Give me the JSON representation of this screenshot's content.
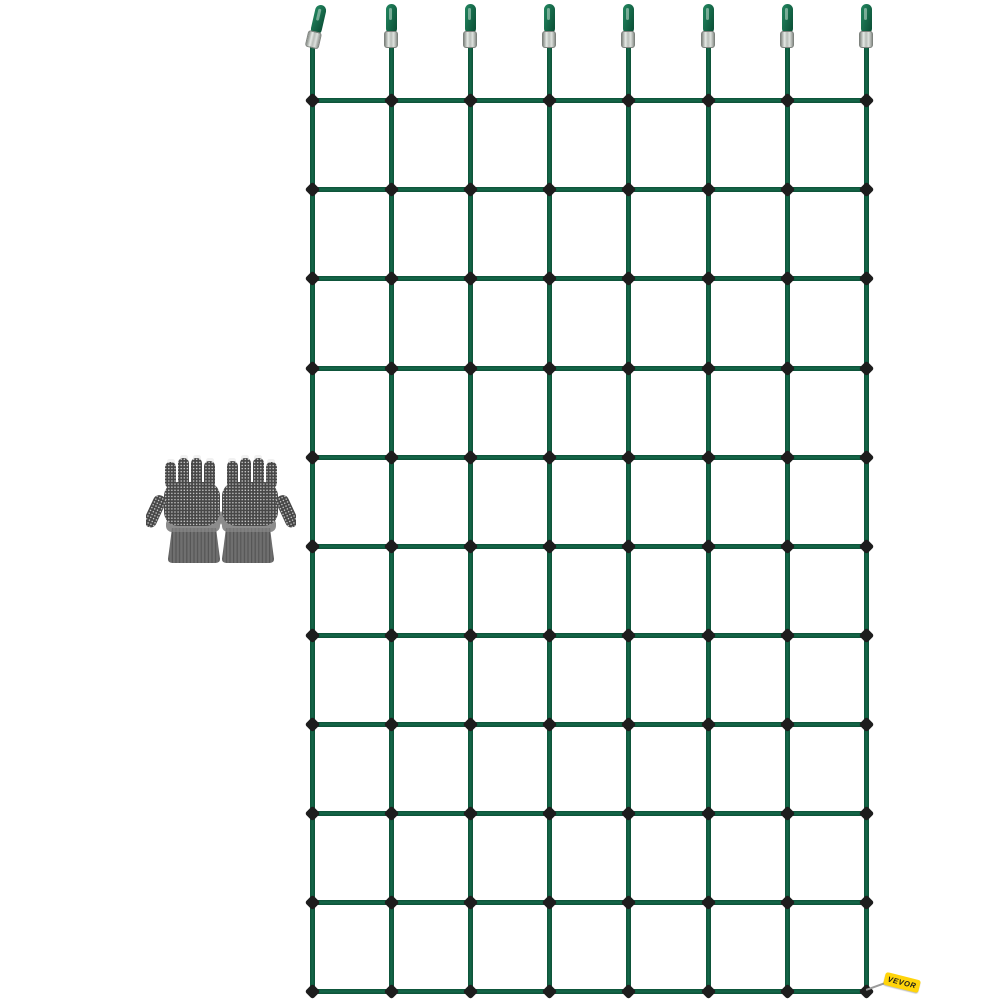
{
  "scene": {
    "background_color": "#ffffff",
    "description": "Product photo: green trellis climbing net with eight top hanging loops, a pair of fingerless grip gloves, and a yellow VEVOR brand tag"
  },
  "net": {
    "rope_color": "#15684a",
    "rope_dark": "#0c5137",
    "rope_width": 5,
    "columns_x": [
      312,
      391,
      470,
      549,
      628,
      708,
      787,
      866
    ],
    "rows_y": [
      100,
      189,
      278,
      368,
      457,
      546,
      635,
      724,
      813,
      902,
      991
    ],
    "horizontal_extent": {
      "x1": 309,
      "x2": 869
    },
    "vertical_extent": {
      "y1": 40,
      "y2": 993
    },
    "connector_color": "#1d1d1d",
    "connector_size": 11,
    "hook": {
      "count": 8,
      "ferrule_light": "#e6eae6",
      "ferrule_dark": "#868b86",
      "first_hook_tilt_deg": 13
    }
  },
  "gloves": {
    "x": 146,
    "y": 452,
    "width": 150,
    "height": 112,
    "base_color": "#474747",
    "dot_color": "#e4e4e4",
    "back_color": "#8c8c8c",
    "cuff_color": "#6f6f6f",
    "cuff_rib_color": "#565656",
    "tip_color": "#f1f1f1"
  },
  "brand_tag": {
    "label": "VEVOR",
    "bg_color": "#FFD40A",
    "text_color": "#1a1a1a",
    "x": 884,
    "y": 976,
    "rotation_deg": 14,
    "string_color": "#9a9a9a",
    "string_x": 866,
    "string_y": 989
  }
}
